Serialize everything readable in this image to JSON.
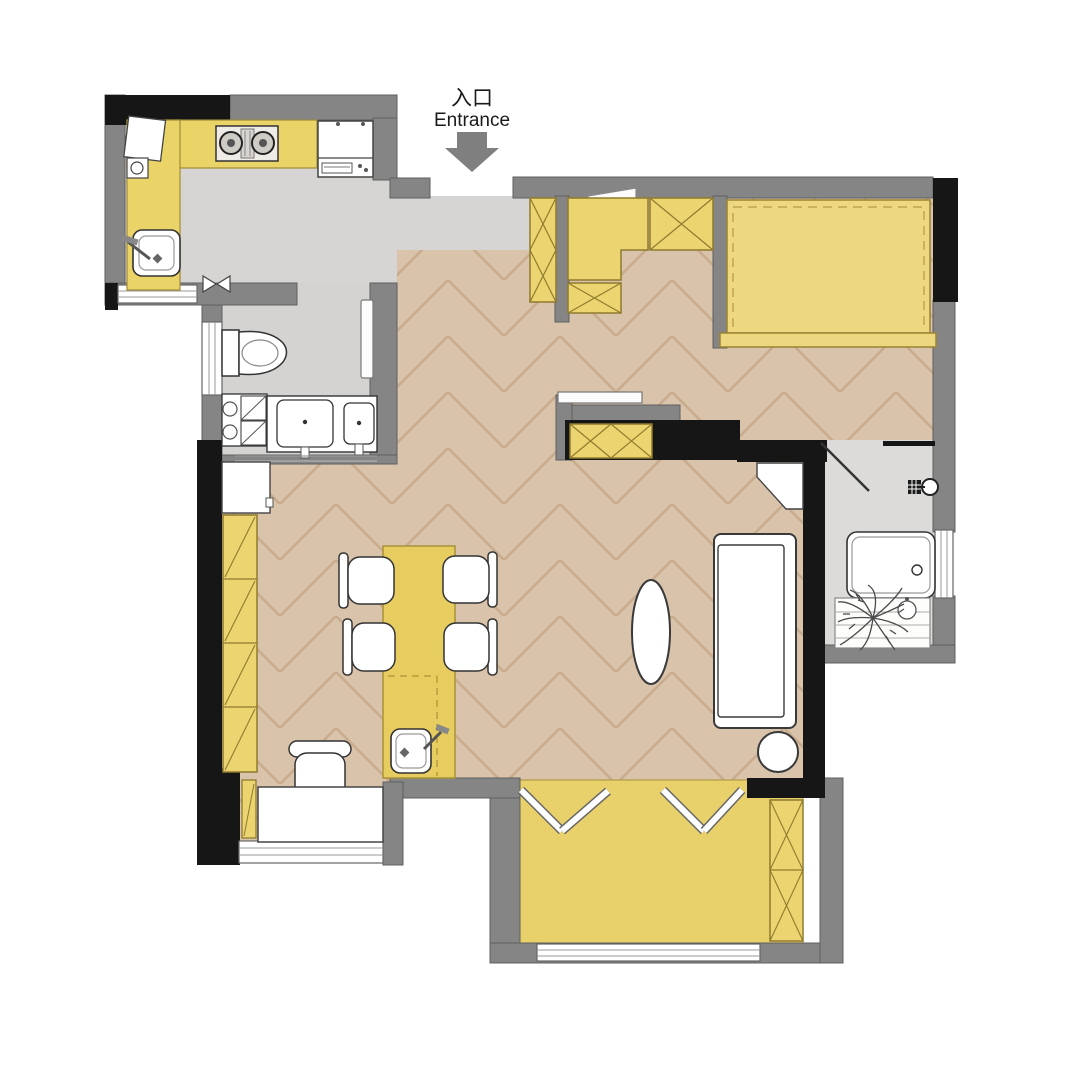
{
  "entrance": {
    "label_cn": "入口",
    "label_en": "Entrance"
  },
  "icons": [
    "entrance-arrow-icon",
    "shower-head-icon",
    "door-panel",
    "window",
    "plant"
  ],
  "palette": {
    "wall_gray": "#858585",
    "wall_black": "#161616",
    "floor_wood": "#d9c3ab",
    "floor_wood_line": "#c7ab8c",
    "floor_tile": "#d6d5d3",
    "bath_tile": "#dcdbd9",
    "furniture_yellow": "#ecd570",
    "furniture_yellow_border": "#8f7b2e",
    "tatami_yellow": "#e8d06a",
    "island_yellow": "#e7cd5f",
    "bed_yellow": "#eed87f",
    "white_fixture": "#ffffff",
    "fixture_line": "#333333",
    "arrow_gray": "#7f7f7f"
  }
}
